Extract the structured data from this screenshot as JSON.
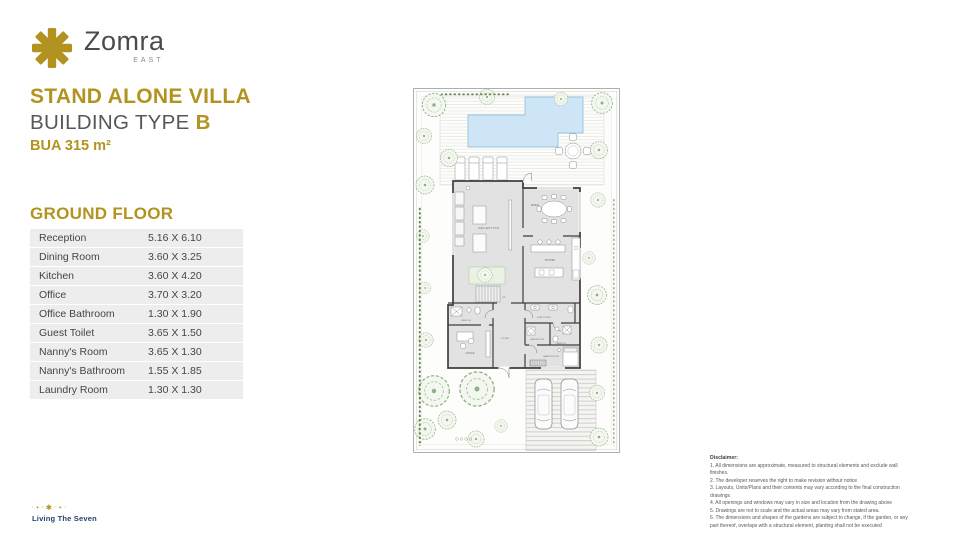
{
  "brand": {
    "name": "Zomra",
    "sub": "EAST"
  },
  "header": {
    "title": "STAND ALONE VILLA",
    "subtitle_prefix": "BUILDING TYPE ",
    "subtitle_highlight": "B",
    "bua": "BUA 315 m²"
  },
  "table": {
    "heading": "GROUND FLOOR",
    "rows": [
      {
        "room": "Reception",
        "dims": "5.16 X 6.10"
      },
      {
        "room": "Dining Room",
        "dims": "3.60 X 3.25"
      },
      {
        "room": "Kitchen",
        "dims": "3.60 X 4.20"
      },
      {
        "room": "Office",
        "dims": "3.70 X 3.20"
      },
      {
        "room": "Office Bathroom",
        "dims": "1.30 X 1.90"
      },
      {
        "room": "Guest Toilet",
        "dims": "3.65 X 1.50"
      },
      {
        "room": "Nanny's Room",
        "dims": "3.65 X 1.30"
      },
      {
        "room": "Nanny's Bathroom",
        "dims": "1.55 X 1.85"
      },
      {
        "room": "Laundry Room",
        "dims": "1.30 X 1.30"
      }
    ]
  },
  "plan": {
    "labels": {
      "reception": "RECEPTION",
      "dining": "DINING",
      "kitchen": "KITCHEN",
      "office": "OFFICE",
      "foyer": "FOYER",
      "guest_toilet": "GUEST TOILET",
      "laundry": "LAUNDRY ROOM",
      "bathroom": "BATHROOM",
      "office_bathroom": "BATHROOM",
      "nanny": "NANNY'S ROOM",
      "up": "UP"
    }
  },
  "disclaimer": {
    "heading": "Disclaimer:",
    "items": [
      "1. All dimensions are approximate, measured to structural elements and exclude wall finishes.",
      "2. The developer reserves the right to make revision without notice",
      "3. Layouts, Units/Plans and their contents may vary according to the final construction drawings",
      "4. All openings and windows may vary in size and location from the drawing above",
      "5. Drawings are not to scale and the actual areas may vary from stated area.",
      "6. The dimensions and shapes of the gardens are subject to change, if the garden, or any part thereof, overlaps with a structural element, planting shall not be executed"
    ]
  },
  "footer": {
    "tagline": "Living The Seven"
  },
  "colors": {
    "gold": "#b3931f",
    "navy": "#24436b",
    "pool": "#cde5f6"
  }
}
